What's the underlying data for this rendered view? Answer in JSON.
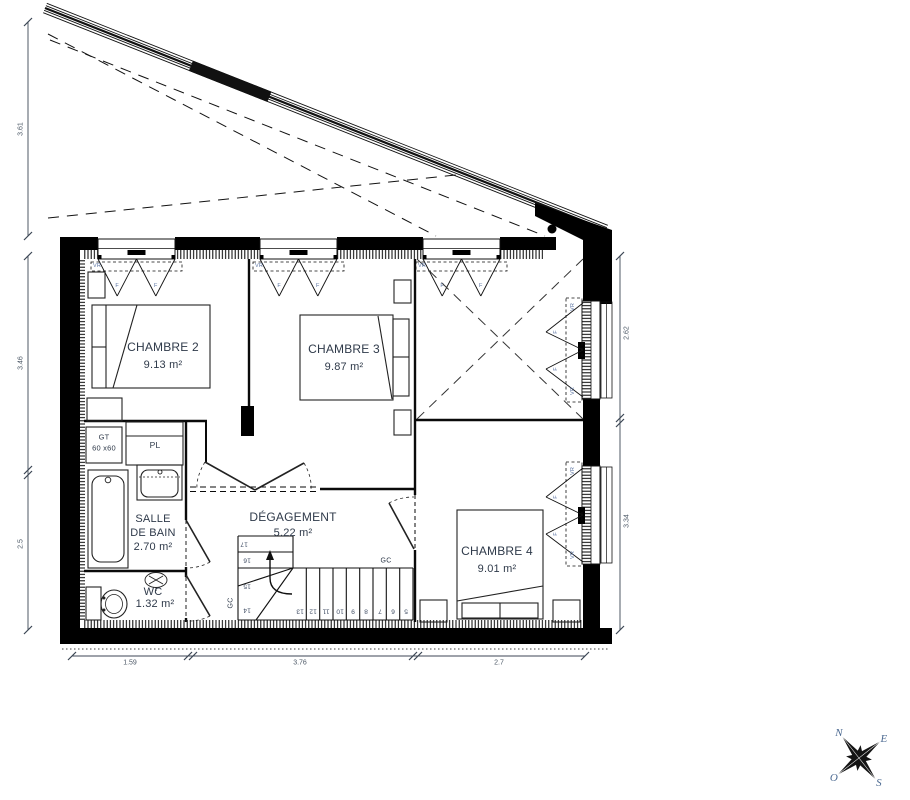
{
  "rooms": {
    "chambre2": {
      "name": "CHAMBRE 2",
      "area": "9.13 m²"
    },
    "chambre3": {
      "name": "CHAMBRE 3",
      "area": "9.87 m²"
    },
    "chambre4": {
      "name": "CHAMBRE 4",
      "area": "9.01 m²"
    },
    "salle_de_bain": {
      "name_line1": "SALLE",
      "name_line2": "DE BAIN",
      "area": "2.70 m²"
    },
    "wc": {
      "name": "WC",
      "area": "1.32 m²"
    },
    "degagement": {
      "name": "DÉGAGEMENT",
      "area": "5.22 m²"
    }
  },
  "labels": {
    "gt": "GT",
    "gt_size": "60 x60",
    "pl": "PL",
    "gc": "GC",
    "vr": "VR",
    "f": "F"
  },
  "stairs": {
    "steps": [
      "5",
      "6",
      "7",
      "8",
      "9",
      "10",
      "11",
      "12",
      "13",
      "14",
      "15",
      "16",
      "17"
    ]
  },
  "dimensions": {
    "left_top": "3.61",
    "left_upper": "3.46",
    "left_lower": "2.5",
    "right_upper": "2.62",
    "right_lower": "3.34",
    "bottom": [
      "1.59",
      "3.76",
      "2.7"
    ]
  },
  "compass": {
    "north": "N",
    "east": "E",
    "south": "S",
    "west": "O"
  },
  "colors": {
    "wall": "#000000",
    "text_dark": "#2f3a4a",
    "text_dim": "#4c5866",
    "text_blue": "#5b74a3"
  }
}
